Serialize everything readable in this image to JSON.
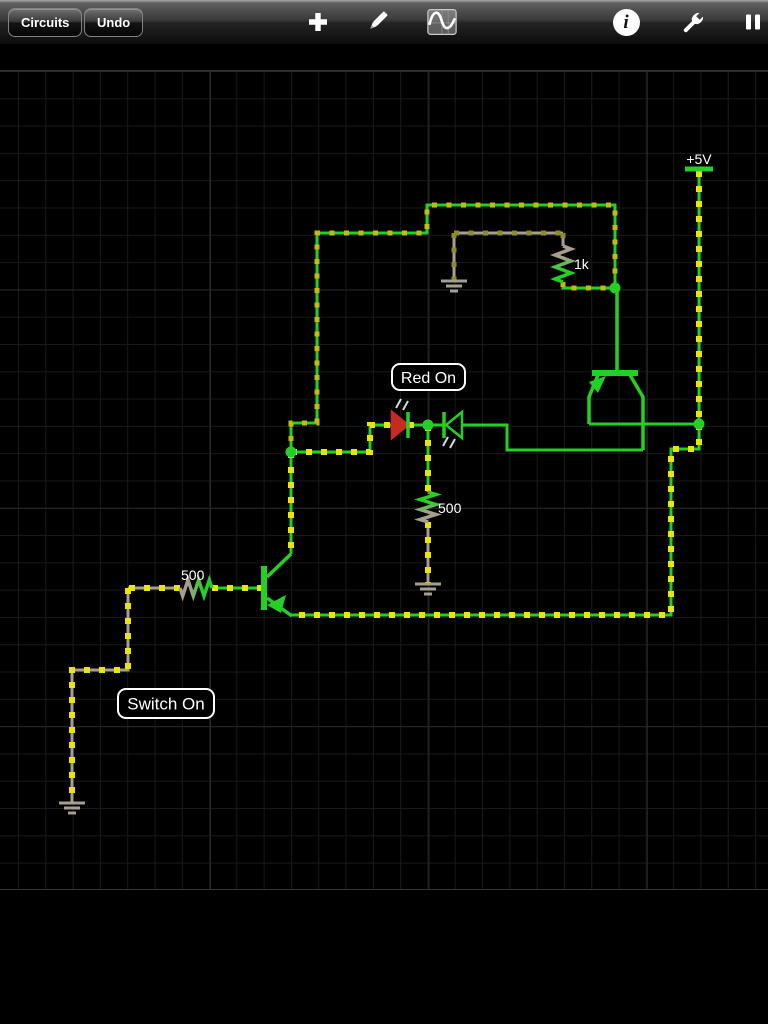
{
  "toolbar": {
    "circuits_label": "Circuits",
    "undo_label": "Undo",
    "icons": [
      "add-icon",
      "edit-pencil-icon",
      "scope-waveform-icon",
      "info-icon",
      "settings-wrench-icon",
      "pause-icon"
    ]
  },
  "canvas": {
    "grid_minor_color": "#191919",
    "grid_major_color": "#282828",
    "background": "#000000"
  },
  "circuit": {
    "colors": {
      "hot": "#25d025",
      "gnd": "#a69e90",
      "dash_bright": "#ece409",
      "dash_mid": "#c6ba10",
      "dash_dim": "#8e8e20",
      "led_red": "#c62a22",
      "ray": "#d8d8d8",
      "label_text": "#ffffff"
    },
    "wires": [
      {
        "name": "supply-rail-wire",
        "net": "hot",
        "cur": "bright",
        "pts": [
          [
            699,
            171
          ],
          [
            699,
            424
          ]
        ]
      },
      {
        "name": "supply-to-emitter-wire",
        "net": "hot",
        "cur": "bright",
        "pts": [
          [
            699,
            424
          ],
          [
            699,
            449
          ],
          [
            671,
            449
          ],
          [
            671,
            615
          ],
          [
            292,
            615
          ]
        ]
      },
      {
        "name": "top-emitter-wire",
        "net": "hot",
        "cur": "none",
        "pts": [
          [
            589,
            424
          ],
          [
            699,
            424
          ]
        ]
      },
      {
        "name": "top-collector-wire",
        "net": "hot",
        "cur": "none",
        "pts": [
          [
            643,
            450
          ],
          [
            507,
            450
          ],
          [
            507,
            425
          ],
          [
            462,
            425
          ]
        ]
      },
      {
        "name": "base-loop-wire",
        "net": "hot",
        "cur": "mid",
        "pts": [
          [
            615,
            288
          ],
          [
            615,
            205
          ],
          [
            427,
            205
          ],
          [
            427,
            233
          ],
          [
            317,
            233
          ],
          [
            317,
            423
          ],
          [
            291,
            423
          ],
          [
            291,
            452
          ]
        ]
      },
      {
        "name": "resistor-1k-bottom-wire",
        "net": "hot",
        "cur": "mid",
        "pts": [
          [
            563,
            282
          ],
          [
            563,
            288
          ],
          [
            615,
            288
          ]
        ]
      },
      {
        "name": "resistor-1k-top-stub",
        "net": "gnd",
        "cur": "dim",
        "pts": [
          [
            563,
            233
          ],
          [
            563,
            246
          ]
        ]
      },
      {
        "name": "ground-horizontal-wire",
        "net": "gnd",
        "cur": "dim",
        "pts": [
          [
            454,
            233
          ],
          [
            563,
            233
          ]
        ]
      },
      {
        "name": "ground-vertical-wire",
        "net": "gnd",
        "cur": "dim",
        "pts": [
          [
            454,
            233
          ],
          [
            454,
            281
          ]
        ]
      },
      {
        "name": "node-to-red-led-wire",
        "net": "hot",
        "cur": "bright",
        "pts": [
          [
            291,
            452
          ],
          [
            370,
            452
          ],
          [
            370,
            425
          ],
          [
            392,
            425
          ]
        ]
      },
      {
        "name": "red-led-to-node-wire",
        "net": "hot",
        "cur": "bright",
        "pts": [
          [
            408,
            425
          ],
          [
            428,
            425
          ]
        ]
      },
      {
        "name": "node-to-green-led-wire",
        "net": "hot",
        "cur": "none",
        "pts": [
          [
            428,
            425
          ],
          [
            444,
            425
          ]
        ]
      },
      {
        "name": "node-to-resistor-wire",
        "net": "hot",
        "cur": "bright",
        "pts": [
          [
            428,
            425
          ],
          [
            428,
            492
          ]
        ]
      },
      {
        "name": "resistor-to-ground-wire",
        "net": "gnd",
        "cur": "bright",
        "pts": [
          [
            428,
            522
          ],
          [
            428,
            584
          ]
        ]
      },
      {
        "name": "bottom-collector-riser-wire",
        "net": "hot",
        "cur": "bright",
        "pts": [
          [
            291,
            452
          ],
          [
            291,
            554
          ]
        ]
      },
      {
        "name": "switch-resistor-wire",
        "net": "gnd",
        "cur": "bright",
        "pts": [
          [
            180,
            588
          ],
          [
            128,
            588
          ]
        ]
      },
      {
        "name": "switch-branch-wire",
        "net": "gnd",
        "cur": "bright",
        "pts": [
          [
            128,
            588
          ],
          [
            128,
            670
          ],
          [
            72,
            670
          ],
          [
            72,
            803
          ]
        ]
      },
      {
        "name": "resistor-to-base-wire",
        "net": "hot",
        "cur": "bright",
        "pts": [
          [
            212,
            588
          ],
          [
            261,
            588
          ]
        ]
      }
    ],
    "resistors": [
      {
        "name": "resistor-1k",
        "label": "1k",
        "orient": "v",
        "x": 563,
        "a": 246,
        "b": 282,
        "c1": "gnd",
        "c2": "hot",
        "label_x": 574,
        "label_y": 269
      },
      {
        "name": "resistor-500-middle",
        "label": "500",
        "orient": "v",
        "x": 428,
        "a": 492,
        "b": 522,
        "c1": "hot",
        "c2": "gnd",
        "label_x": 438,
        "label_y": 513
      },
      {
        "name": "resistor-500-left",
        "label": "500",
        "orient": "h",
        "y": 588,
        "a": 180,
        "b": 212,
        "c1": "gnd",
        "c2": "hot",
        "label_x": 181,
        "label_y": 580
      }
    ],
    "transistors": [
      {
        "name": "transistor-pnp-top",
        "bar": [
          592,
          370,
          46,
          6
        ],
        "leads": [
          [
            [
              617,
              288
            ],
            [
              617,
              370
            ]
          ],
          [
            [
              598,
              375
            ],
            [
              589,
              397
            ],
            [
              589,
              424
            ]
          ],
          [
            [
              630,
              375
            ],
            [
              643,
              397
            ],
            [
              643,
              450
            ]
          ]
        ],
        "arrow": [
          [
            606,
            376
          ],
          [
            589,
            382
          ],
          [
            598,
            393
          ]
        ]
      },
      {
        "name": "transistor-pnp-bottom",
        "bar": [
          261,
          566,
          6,
          44
        ],
        "leads": [
          [
            [
              267,
              577
            ],
            [
              291,
              554
            ]
          ],
          [
            [
              267,
              598
            ],
            [
              292,
              616
            ]
          ]
        ],
        "arrow": [
          [
            267,
            605
          ],
          [
            286,
            595
          ],
          [
            281,
            613
          ]
        ]
      }
    ],
    "leds": [
      {
        "name": "led-red-on",
        "tri": [
          [
            392,
            412
          ],
          [
            392,
            438
          ],
          [
            408,
            425
          ]
        ],
        "lit": true,
        "bar": [
          [
            408,
            412
          ],
          [
            408,
            438
          ]
        ],
        "rays": [
          [
            [
              396,
              408
            ],
            [
              401,
              399
            ]
          ],
          [
            [
              403,
              410
            ],
            [
              408,
              401
            ]
          ]
        ]
      },
      {
        "name": "led-green-off",
        "tri": [
          [
            462,
            412
          ],
          [
            462,
            438
          ],
          [
            446,
            425
          ]
        ],
        "lit": false,
        "bar": [
          [
            444,
            412
          ],
          [
            444,
            438
          ]
        ],
        "rays": [
          [
            [
              443,
              446
            ],
            [
              448,
              437
            ]
          ],
          [
            [
              450,
              448
            ],
            [
              455,
              439
            ]
          ]
        ]
      }
    ],
    "grounds": [
      {
        "name": "ground-symbol-top",
        "x": 454,
        "y": 281
      },
      {
        "name": "ground-symbol-middle",
        "x": 428,
        "y": 584
      },
      {
        "name": "ground-symbol-left",
        "x": 72,
        "y": 803
      }
    ],
    "junction_dots": [
      [
        291,
        452
      ],
      [
        428,
        425
      ],
      [
        615,
        288
      ],
      [
        699,
        424
      ]
    ],
    "power_rail": {
      "label": "+5V",
      "x": 699,
      "bar_y": 169,
      "half_w": 14,
      "label_y": 164
    },
    "annotations": [
      {
        "name": "annotation-red-on",
        "text": "Red On",
        "x": 392,
        "y": 364,
        "w": 73,
        "h": 26,
        "font": 16
      },
      {
        "name": "annotation-switch-on",
        "text": "Switch On",
        "x": 118,
        "y": 689,
        "w": 96,
        "h": 29,
        "font": 17
      }
    ]
  }
}
